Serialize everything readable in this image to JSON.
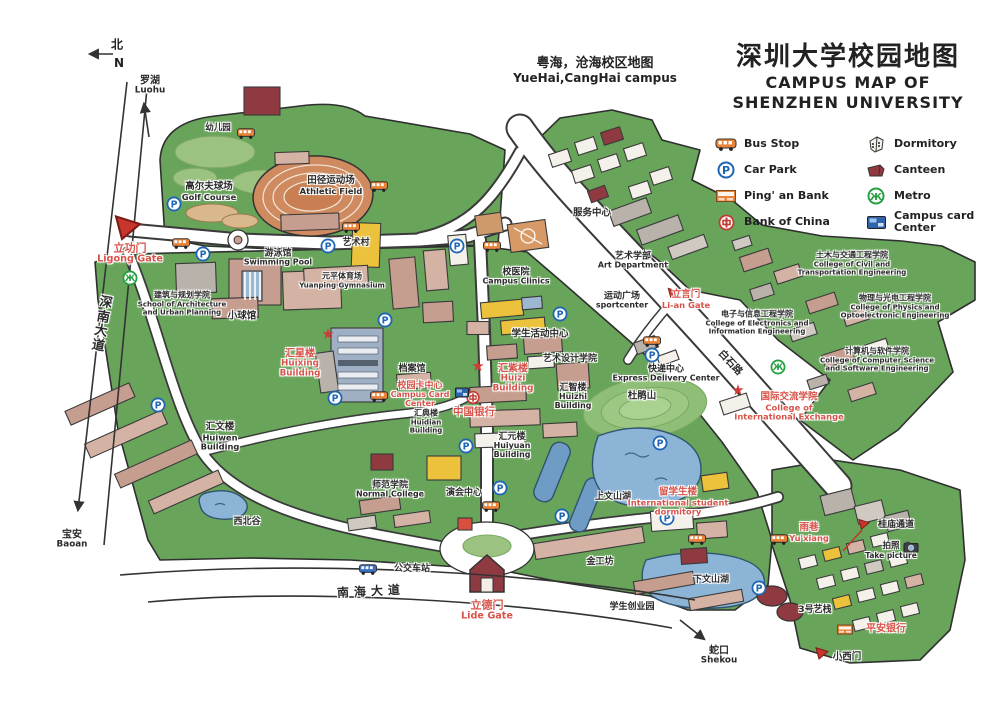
{
  "title": {
    "zh": "深圳大学校园地图",
    "en1": "CAMPUS MAP OF",
    "en2": "SHENZHEN UNIVERSITY"
  },
  "subtitle": {
    "zh": "粤海，沧海校区地图",
    "en": "YueHai,CangHai campus"
  },
  "compass": {
    "zh": "北",
    "en": "N"
  },
  "colors": {
    "campus_green": "#68a45a",
    "light_green": "#9cc281",
    "road_white": "#ffffff",
    "lake_blue": "#8cb4d6",
    "building_tan": "#c59e90",
    "canteen_red": "#8e3a40",
    "accent_red": "#d8534a",
    "track_orange": "#d08a5f"
  },
  "legend": {
    "items": [
      {
        "icon": "bus-icon",
        "label": "Bus Stop"
      },
      {
        "icon": "dormitory-icon",
        "label": "Dormitory"
      },
      {
        "icon": "car-park-icon",
        "label": "Car Park"
      },
      {
        "icon": "canteen-icon",
        "label": "Canteen"
      },
      {
        "icon": "pingan-bank-icon",
        "label": "Ping' an Bank"
      },
      {
        "icon": "metro-icon",
        "label": "Metro"
      },
      {
        "icon": "bank-of-china-icon",
        "label": "Bank of China"
      },
      {
        "icon": "campus-card-icon",
        "label": "Campus card Center"
      }
    ]
  },
  "map": {
    "labels": [
      {
        "id": "luohu",
        "x": 150,
        "y": 86,
        "lines": [
          "罗湖",
          "Luohu"
        ],
        "size": 10
      },
      {
        "id": "kindergarten",
        "x": 218,
        "y": 129,
        "lines": [
          "幼儿园"
        ],
        "size": 8.5
      },
      {
        "id": "golf-course",
        "x": 209,
        "y": 192,
        "lines": [
          "高尔夫球场",
          "Golf Course"
        ],
        "size": 9.5
      },
      {
        "id": "athletic-field",
        "x": 331,
        "y": 186,
        "lines": [
          "田径运动场",
          "Athletic Field"
        ],
        "size": 9.5
      },
      {
        "id": "ligong-gate",
        "x": 130,
        "y": 254,
        "cls": "red",
        "lines": [
          "立功门",
          "Ligong Gate"
        ],
        "size": 11
      },
      {
        "id": "shennan-avenue",
        "x": 102,
        "y": 325,
        "lines": [
          "深",
          "南",
          "大",
          "道"
        ],
        "size": 13,
        "rot": 10
      },
      {
        "id": "baoan",
        "x": 72,
        "y": 540,
        "lines": [
          "宝安",
          "Baoan"
        ],
        "size": 10
      },
      {
        "id": "architecture-school",
        "x": 182,
        "y": 304,
        "lines": [
          "建筑与规划学院",
          "School of Architecture",
          "and Urban Planning"
        ],
        "size": 8
      },
      {
        "id": "swimming-pool",
        "x": 278,
        "y": 258,
        "lines": [
          "游泳馆",
          "Swimming Pool"
        ],
        "size": 9
      },
      {
        "id": "yuanping-gym",
        "x": 342,
        "y": 281,
        "lines": [
          "元平体育场",
          "Yuanping Gymnasium"
        ],
        "size": 8
      },
      {
        "id": "small-ball-gym",
        "x": 242,
        "y": 317,
        "lines": [
          "小球馆"
        ],
        "size": 9.5
      },
      {
        "id": "art-village",
        "x": 356,
        "y": 243,
        "lines": [
          "艺术村"
        ],
        "size": 9
      },
      {
        "id": "service-center",
        "x": 592,
        "y": 214,
        "lines": [
          "服务中心"
        ],
        "size": 9.5
      },
      {
        "id": "art-department",
        "x": 633,
        "y": 261,
        "lines": [
          "艺术学部",
          "Art Department"
        ],
        "size": 9
      },
      {
        "id": "campus-clinics",
        "x": 516,
        "y": 277,
        "lines": [
          "校医院",
          "Campus Clinics"
        ],
        "size": 9
      },
      {
        "id": "sport-center",
        "x": 622,
        "y": 301,
        "lines": [
          "运动广场",
          "sportcenter"
        ],
        "size": 9
      },
      {
        "id": "liyan-gate",
        "x": 686,
        "y": 300,
        "cls": "red",
        "lines": [
          "立言门",
          "Li-an Gate"
        ],
        "size": 9.5
      },
      {
        "id": "student-activity-center",
        "x": 540,
        "y": 335,
        "lines": [
          "学生活动中心"
        ],
        "size": 9.5
      },
      {
        "id": "huixing-building",
        "x": 300,
        "y": 364,
        "cls": "red",
        "lines": [
          "汇星楼",
          "Huixing",
          "Building"
        ],
        "size": 10
      },
      {
        "id": "archives",
        "x": 412,
        "y": 369,
        "lines": [
          "档案馆"
        ],
        "size": 9
      },
      {
        "id": "campus-card-center",
        "x": 420,
        "y": 395,
        "cls": "red",
        "lines": [
          "校园卡中心",
          "Campus Card",
          "Center"
        ],
        "size": 9
      },
      {
        "id": "huidian-building",
        "x": 426,
        "y": 422,
        "lines": [
          "汇典楼",
          "Huidian",
          "Building"
        ],
        "size": 8
      },
      {
        "id": "bank-of-china",
        "x": 474,
        "y": 413,
        "cls": "red",
        "lines": [
          "中国银行"
        ],
        "size": 10.5
      },
      {
        "id": "huizi-building",
        "x": 513,
        "y": 379,
        "cls": "red",
        "lines": [
          "汇紫楼",
          "Huizi",
          "Building"
        ],
        "size": 10
      },
      {
        "id": "art-design-college",
        "x": 570,
        "y": 359,
        "lines": [
          "艺术设计学院"
        ],
        "size": 9
      },
      {
        "id": "huizhi-building",
        "x": 573,
        "y": 397,
        "lines": [
          "汇智楼",
          "Huizhi",
          "Building"
        ],
        "size": 9
      },
      {
        "id": "huiyuan-building",
        "x": 512,
        "y": 446,
        "lines": [
          "汇元楼",
          "Huiyuan",
          "Building"
        ],
        "size": 9
      },
      {
        "id": "express-delivery-center",
        "x": 666,
        "y": 374,
        "lines": [
          "快递中心",
          "Express Delivery Center"
        ],
        "size": 9
      },
      {
        "id": "dujuan-hill",
        "x": 642,
        "y": 397,
        "lines": [
          "杜鹃山"
        ],
        "size": 9.5
      },
      {
        "id": "baishi-road",
        "x": 730,
        "y": 363,
        "lines": [
          "白石路"
        ],
        "size": 10,
        "rot": 47
      },
      {
        "id": "electronics-college",
        "x": 757,
        "y": 323,
        "lines": [
          "电子与信息工程学院",
          "College of Electronics and",
          "Information Engineering"
        ],
        "size": 8
      },
      {
        "id": "civil-college",
        "x": 852,
        "y": 264,
        "lines": [
          "土木与交通工程学院",
          "College of Civil and",
          "Transportation Engineering"
        ],
        "size": 8
      },
      {
        "id": "physics-college",
        "x": 895,
        "y": 307,
        "lines": [
          "物理与光电工程学院",
          "College of Physics and",
          "Optoelectronic Engineering"
        ],
        "size": 8
      },
      {
        "id": "computer-college",
        "x": 877,
        "y": 360,
        "lines": [
          "计算机与软件学院",
          "College of Computer Science",
          "and Software Engineering"
        ],
        "size": 8
      },
      {
        "id": "intl-exchange-college",
        "x": 789,
        "y": 407,
        "cls": "red",
        "lines": [
          "国际交流学院",
          "College of",
          "International Exchange"
        ],
        "size": 9.5
      },
      {
        "id": "huiwen-building",
        "x": 220,
        "y": 437,
        "lines": [
          "汇文楼",
          "Huiwen",
          "Building"
        ],
        "size": 9.5
      },
      {
        "id": "xibei-valley",
        "x": 247,
        "y": 522,
        "lines": [
          "西北谷"
        ],
        "size": 9
      },
      {
        "id": "normal-college",
        "x": 390,
        "y": 490,
        "lines": [
          "师范学院",
          "Normal College"
        ],
        "size": 9
      },
      {
        "id": "performance-center",
        "x": 464,
        "y": 493,
        "lines": [
          "演会中心"
        ],
        "size": 9
      },
      {
        "id": "bus-station",
        "x": 412,
        "y": 569,
        "lines": [
          "公交车站"
        ],
        "size": 9
      },
      {
        "id": "nanhai-avenue",
        "x": 371,
        "y": 592,
        "lines": [
          "南海大道"
        ],
        "size": 12,
        "rot": -3,
        "ls": 5
      },
      {
        "id": "lide-gate",
        "x": 487,
        "y": 611,
        "cls": "red",
        "lines": [
          "立德门",
          "Lide Gate"
        ],
        "size": 11
      },
      {
        "id": "jingong-workshop",
        "x": 600,
        "y": 562,
        "lines": [
          "金工坊"
        ],
        "size": 9
      },
      {
        "id": "shangwenshan-lake",
        "x": 613,
        "y": 497,
        "lines": [
          "上文山湖"
        ],
        "size": 9
      },
      {
        "id": "startup-park",
        "x": 632,
        "y": 607,
        "lines": [
          "学生创业园"
        ],
        "size": 9
      },
      {
        "id": "intl-student-dorm",
        "x": 678,
        "y": 502,
        "cls": "red",
        "lines": [
          "留学生楼",
          "International student",
          "dormitory"
        ],
        "size": 9.5
      },
      {
        "id": "yuxiang",
        "x": 809,
        "y": 533,
        "cls": "red",
        "lines": [
          "雨巷",
          "Yu'xiang"
        ],
        "size": 9.5
      },
      {
        "id": "xiawenshan-lake",
        "x": 711,
        "y": 580,
        "lines": [
          "下文山湖"
        ],
        "size": 9
      },
      {
        "id": "guimiao-passage",
        "x": 896,
        "y": 525,
        "lines": [
          "桂庙通道"
        ],
        "size": 9
      },
      {
        "id": "take-picture",
        "x": 891,
        "y": 551,
        "lines": [
          "拍照",
          "Take picture"
        ],
        "size": 8.5
      },
      {
        "id": "no3-art-inn",
        "x": 815,
        "y": 610,
        "lines": [
          "3号艺栈"
        ],
        "size": 9
      },
      {
        "id": "pingan-bank",
        "x": 886,
        "y": 629,
        "cls": "red",
        "lines": [
          "平安银行"
        ],
        "size": 10
      },
      {
        "id": "xiaoximen-gate",
        "x": 847,
        "y": 658,
        "lines": [
          "小西门"
        ],
        "size": 9.5
      },
      {
        "id": "shekou",
        "x": 719,
        "y": 656,
        "lines": [
          "蛇口",
          "Shekou"
        ],
        "size": 10
      }
    ],
    "markers": [
      {
        "t": "carpark",
        "x": 174,
        "y": 206
      },
      {
        "t": "carpark",
        "x": 203,
        "y": 256
      },
      {
        "t": "carpark",
        "x": 328,
        "y": 248
      },
      {
        "t": "carpark",
        "x": 457,
        "y": 248
      },
      {
        "t": "carpark",
        "x": 385,
        "y": 322
      },
      {
        "t": "carpark",
        "x": 560,
        "y": 316
      },
      {
        "t": "carpark",
        "x": 652,
        "y": 357
      },
      {
        "t": "carpark",
        "x": 335,
        "y": 400
      },
      {
        "t": "carpark",
        "x": 466,
        "y": 448
      },
      {
        "t": "carpark",
        "x": 660,
        "y": 445
      },
      {
        "t": "carpark",
        "x": 158,
        "y": 407
      },
      {
        "t": "carpark",
        "x": 500,
        "y": 490
      },
      {
        "t": "carpark",
        "x": 562,
        "y": 518
      },
      {
        "t": "carpark",
        "x": 667,
        "y": 520
      },
      {
        "t": "carpark",
        "x": 759,
        "y": 590
      },
      {
        "t": "metro",
        "x": 130,
        "y": 280
      },
      {
        "t": "metro",
        "x": 778,
        "y": 369
      },
      {
        "t": "bus",
        "x": 246,
        "y": 134
      },
      {
        "t": "bus",
        "x": 181,
        "y": 244
      },
      {
        "t": "bus",
        "x": 379,
        "y": 187
      },
      {
        "t": "bus",
        "x": 351,
        "y": 228
      },
      {
        "t": "bus",
        "x": 492,
        "y": 247
      },
      {
        "t": "bus",
        "x": 652,
        "y": 342
      },
      {
        "t": "bus",
        "x": 379,
        "y": 397
      },
      {
        "t": "bus",
        "x": 697,
        "y": 540
      },
      {
        "t": "bus",
        "x": 779,
        "y": 540
      },
      {
        "t": "bus",
        "x": 491,
        "y": 507
      },
      {
        "t": "bus",
        "x": 368,
        "y": 570,
        "c": "#3b6fc4"
      },
      {
        "t": "star",
        "x": 328,
        "y": 336
      },
      {
        "t": "star",
        "x": 478,
        "y": 368
      },
      {
        "t": "star",
        "x": 738,
        "y": 392
      },
      {
        "t": "boc",
        "x": 473,
        "y": 399
      },
      {
        "t": "card",
        "x": 462,
        "y": 392
      },
      {
        "t": "pingan",
        "x": 845,
        "y": 629
      },
      {
        "t": "camera",
        "x": 911,
        "y": 547
      },
      {
        "t": "tri",
        "x": 128,
        "y": 229,
        "s": 30
      },
      {
        "t": "tri",
        "x": 673,
        "y": 293,
        "s": 12
      },
      {
        "t": "tri",
        "x": 864,
        "y": 525,
        "s": 13
      },
      {
        "t": "tri",
        "x": 822,
        "y": 655,
        "s": 15
      }
    ]
  }
}
